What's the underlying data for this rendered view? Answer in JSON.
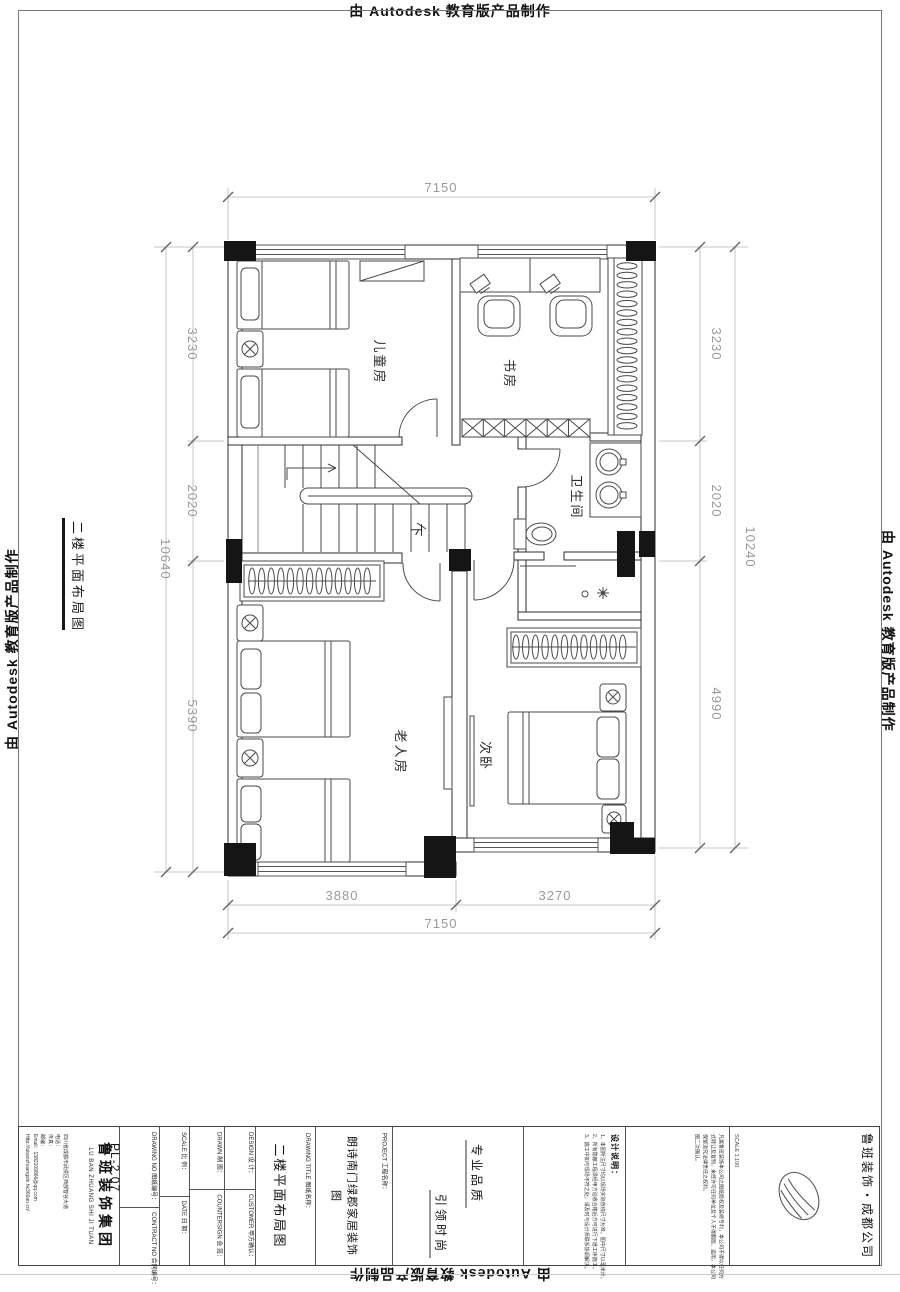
{
  "watermark": {
    "text": "由 Autodesk 教育版产品制作"
  },
  "sheet": {
    "side_label": "二楼平面布局图"
  },
  "plan": {
    "rooms": {
      "child": "儿童房",
      "study": "书房",
      "bath": "卫生间",
      "elder": "老人房",
      "second": "次卧",
      "stair_down": "下"
    },
    "dims": {
      "w": "7150",
      "b1": "3880",
      "b2": "3270",
      "wb": "7150",
      "l1": "3230",
      "l2": "2020",
      "l3": "5390",
      "lt": "10640",
      "r1": "3230",
      "r2": "2020",
      "r3": "4990",
      "rt": "10240"
    }
  },
  "titleblock": {
    "company_cn": "鲁班装饰集团",
    "company_en": "LU BAN ZHUANG SHI JI TUAN",
    "address": "四川省成都市武侯区西部智谷大道",
    "phone": "电话：",
    "fax": "传真：",
    "zip": "邮编：",
    "email": "Email：1382109866@qq.com",
    "web": "Http://lubanzhuangshi.hk360an.cn/",
    "drawing_no_label": "DRAWING NO 图纸编号：",
    "drawing_no": "PL-2.07",
    "contract_label": "CONTRACT NO 合同编号：",
    "scale_label": "SCALE 比 例：",
    "date_label": "DATE 日 期：",
    "drawn_label": "DRAWN 制 图：",
    "countersign_label": "COUNTERSIGN 会 签：",
    "design_label": "DESIGN 设 计：",
    "customer_label": "CUSTOMER 甲方确认：",
    "title_label": "DRAWING TITLE 图纸名称：",
    "drawing_title": "二楼平面布局图",
    "project_label": "PROJECT 工程名称：",
    "project_name": "朗诗南门绿郡家居装饰图",
    "slogan1": "专业品质",
    "slogan2": "引领时尚",
    "notes_title": "设计说明：",
    "notes": [
      "1、本图所注尺寸均以现场实际放线尺寸为准，图中尺寸以毫米计。",
      "2、所有隐蔽工程须经甲方验收合格后方可进行下道工序施工。",
      "3、施工中如与现场不符之处，请及时与设计师联系协调解决。"
    ],
    "copyright": [
      "凡属鲁班装饰本公司之图纸版权及装修专利，本公司不得以任何方",
      "式转让及复制，未经许可任何单位及个人不得翻版、盗用，本公司",
      "保留追究法律责任之权利。",
      "图二次确认。"
    ],
    "scale_text": "SCALE 1:100",
    "branch": "鲁班装饰・成都公司"
  }
}
